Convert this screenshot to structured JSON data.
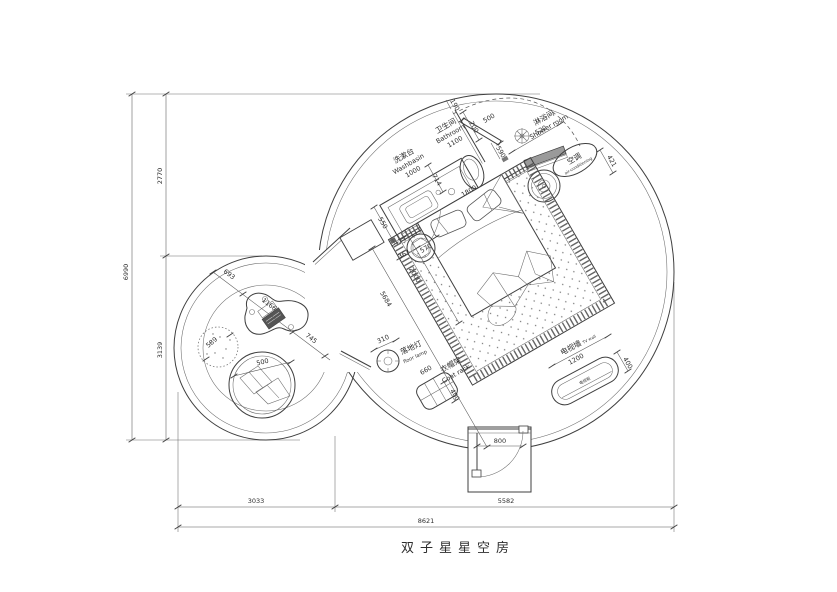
{
  "title": "双子星星空房",
  "labels": {
    "washbasin": {
      "zh": "洗漱台",
      "en": "Washbasin",
      "dim": "1000"
    },
    "bathroom": {
      "zh": "卫生间",
      "en": "Bathroom",
      "dim": "1100"
    },
    "shower": {
      "zh": "淋浴间",
      "en": "Shower room"
    },
    "ac": {
      "zh": "空调",
      "en": "air-conditioning"
    },
    "floor_lamp": {
      "zh": "落地灯",
      "en": "floor lamp",
      "dim": "310"
    },
    "coat_rack": {
      "zh": "衣帽架",
      "en": "Coat rack",
      "w": "660",
      "h": "400"
    },
    "tv": {
      "zh": "电视墙",
      "en": "TV wall",
      "w": "1200",
      "h": "400",
      "cabinet": "电视柜"
    }
  },
  "dims": {
    "d190": "190",
    "d700": "700",
    "d500_shower": "500",
    "d520": "520",
    "d421": "421",
    "d590": "590",
    "d714": "714",
    "d550": "550",
    "d1800": "1800",
    "d2000": "2000",
    "d5684": "5684",
    "d363": "363",
    "d570": "570",
    "d800": "800",
    "d693": "693",
    "d1166": "1166",
    "d745": "745",
    "d589": "589",
    "d500_cushion": "500"
  },
  "outer_dims": {
    "height_total": "6990",
    "height_upper": "2770",
    "height_lower": "3139",
    "width_left": "3033",
    "width_right": "5582",
    "width_total": "8621"
  }
}
